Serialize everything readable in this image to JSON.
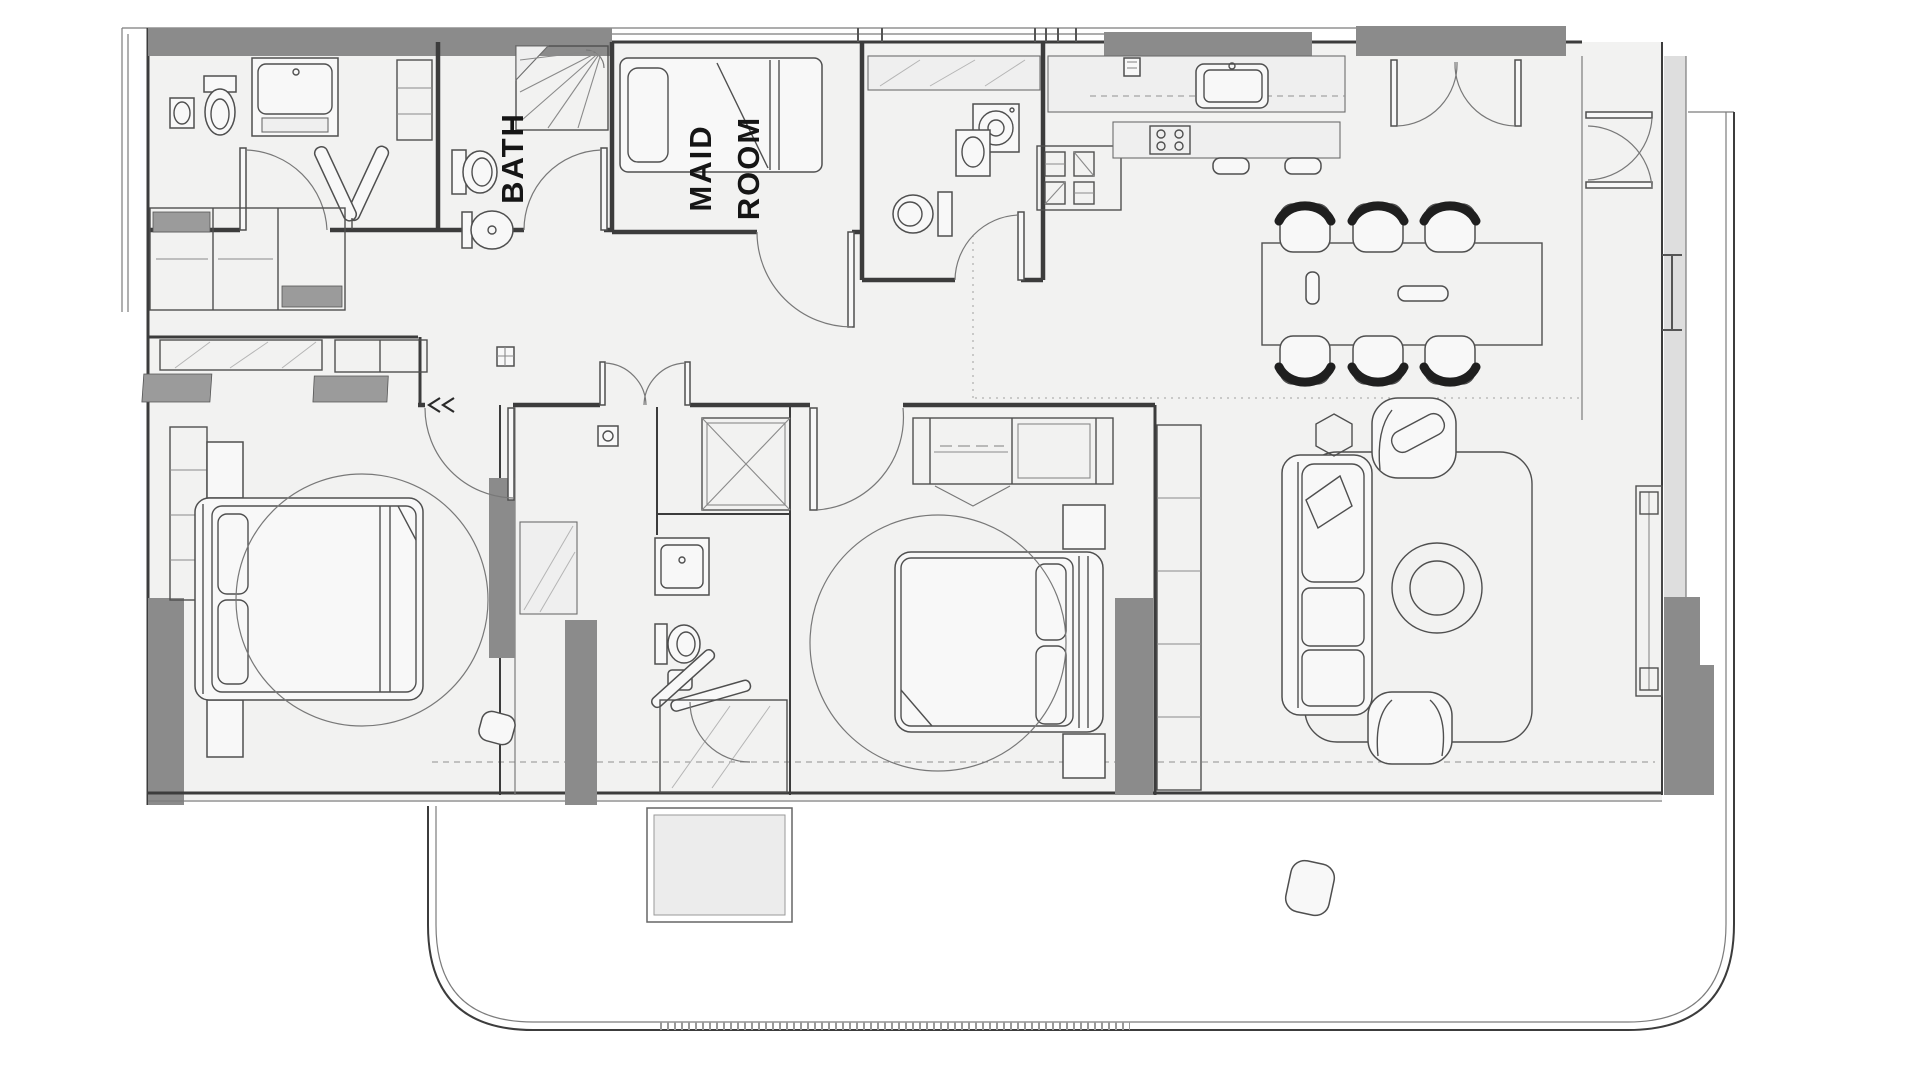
{
  "title": "Apartment unit floor plan",
  "labels": {
    "bath": "BATH",
    "maid_line1": "MAID",
    "maid_line2": "ROOM"
  },
  "colors": {
    "background": "#ffffff",
    "floor": "#f2f2f1",
    "wallGray": "#8b8b8b",
    "wallLight": "#dedede",
    "lineDark": "#3c3c3c",
    "furnitureLine": "#4f4f4f",
    "accentDark": "#1f1f1f",
    "labelColor": "#151515",
    "planterFill": "#ececec"
  }
}
